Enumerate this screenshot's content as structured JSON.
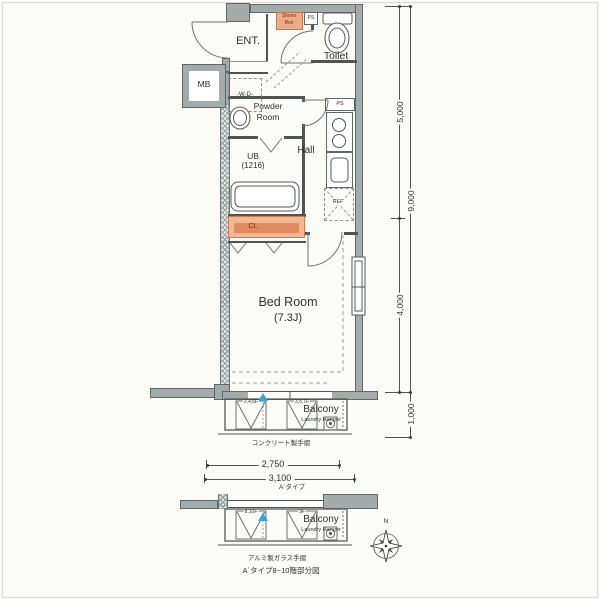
{
  "rooms": {
    "ent": "ENT.",
    "toilet": "Toilet",
    "powder": [
      "Powder",
      "Room"
    ],
    "ub": [
      "UB",
      "(1216)"
    ],
    "hall": "Hall",
    "bedroom": [
      "Bed Room",
      "(7.3J)"
    ],
    "cl": "CL",
    "mb": "MB",
    "shoes_box": [
      "Shoes",
      "Box"
    ],
    "wd": "-W-D-",
    "ps_entry": "PS",
    "ps_hall": "PS",
    "ref": "REF"
  },
  "balcony_main": {
    "name": "Balcony",
    "laundry": "Laundry Hanger",
    "hatch_left": "2,4,6F",
    "hatch_right": "3,5,7F",
    "handrail_note": "コンクリート製手摺"
  },
  "balcony_detail": {
    "name": "Balcony",
    "laundry": "Laundry Hanger",
    "hatch_left": "8,10F",
    "hatch_right": "9F",
    "handrail_note": "アルミ製ガラス手摺",
    "caption": "A´タイプ8~10階部分図"
  },
  "dimensions": {
    "v5000": "5,000",
    "v9000": "9,000",
    "v4000": "4,000",
    "v1000": "1,000",
    "h2750": "2,750",
    "h3100": "3,100",
    "type_label": "A´タイプ"
  },
  "compass": {
    "north": "N"
  },
  "colors": {
    "wall": "#a3acaa",
    "accent_orange": "#efab87",
    "cl_band": "#dd8a62",
    "blue_marker": "#3f9fd8",
    "line": "#4e5452"
  }
}
